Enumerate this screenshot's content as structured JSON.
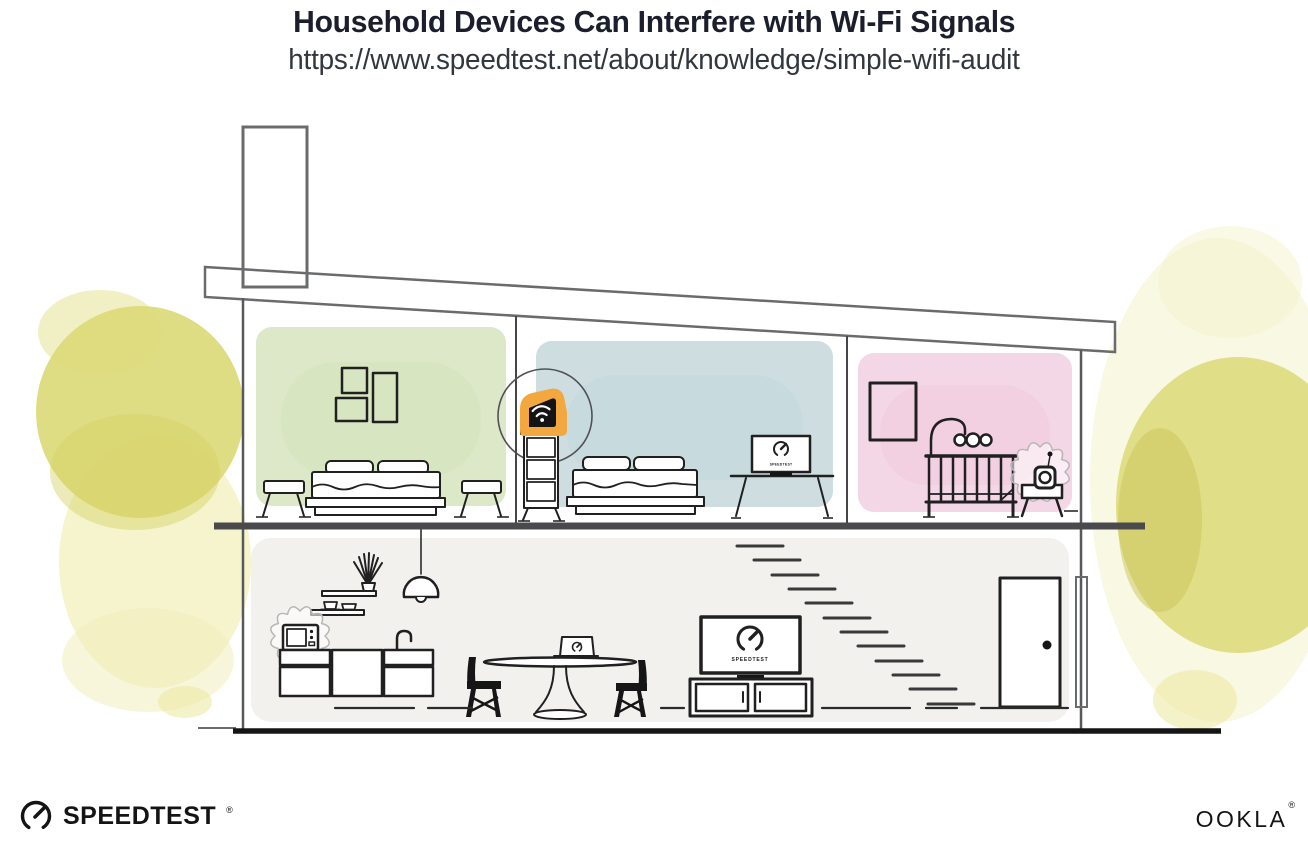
{
  "header": {
    "title": "Household Devices Can Interfere with Wi-Fi Signals",
    "url": "https://www.speedtest.net/about/knowledge/simple-wifi-audit"
  },
  "screens": {
    "bedroom_monitor_label": "SPEEDTEST",
    "living_room_tv_label": "SPEEDTEST"
  },
  "footer": {
    "speedtest_wordmark": "SPEEDTEST",
    "speedtest_reg": "®",
    "ookla_wordmark": "OOKLA",
    "ookla_reg": "®"
  },
  "icons": {
    "router": "wifi-router-icon",
    "speed_gauge": "speedtest-gauge-icon",
    "microwave": "microwave-icon",
    "baby_monitor": "baby-monitor-icon",
    "interference": "interference-burst-icon"
  },
  "colors": {
    "title_text": "#1b1f2d",
    "accent_orange": "#f3a73f",
    "green_room": "#dce8c8",
    "blue_room": "#cddde0",
    "pink_room": "#f4d7e6",
    "lower_floor": "#f2f1ee",
    "foliage_yellow": "#dcd977",
    "structure_gray": "#6a6b6d",
    "ink": "#202021"
  }
}
